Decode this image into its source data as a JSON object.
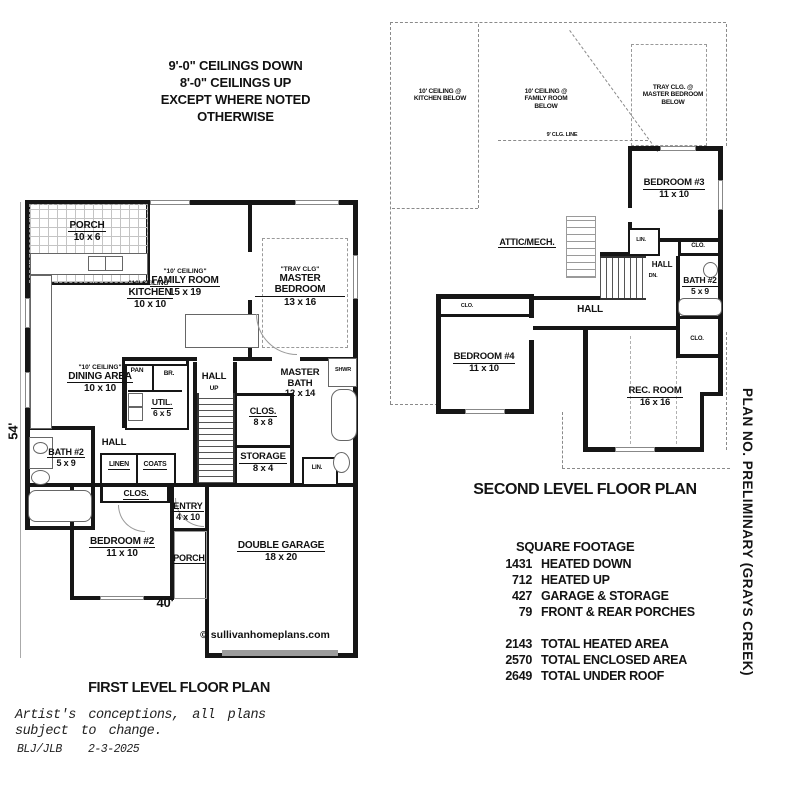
{
  "colors": {
    "ink": "#141414",
    "dash": "#8a8a8a",
    "background": "#ffffff"
  },
  "ceiling_note": {
    "line1": "9'-0\" CEILINGS DOWN",
    "line2": "8'-0\" CEILINGS UP",
    "line3": "EXCEPT WHERE NOTED",
    "line4": "OTHERWISE"
  },
  "first_floor": {
    "title": "FIRST LEVEL FLOOR PLAN",
    "dim_height": "54'",
    "dim_width": "40'",
    "copyright": "© sullivanhomeplans.com",
    "porch_top": {
      "name": "PORCH",
      "size": "10 x 6"
    },
    "kitchen": {
      "ceiling": "\"10' CEILING\"",
      "name": "KITCHEN",
      "size": "10 x 10"
    },
    "family": {
      "ceiling": "\"10' CEILING\"",
      "name": "FAMILY ROOM",
      "size": "15 x 19"
    },
    "master_bedroom": {
      "ceiling": "\"TRAY CLG\"",
      "name": "MASTER BEDROOM",
      "size": "13 x 16"
    },
    "dining": {
      "ceiling": "\"10' CEILING\"",
      "name": "DINING AREA",
      "size": "10 x 10"
    },
    "pantry": "PAN",
    "broom": "BR.",
    "util": {
      "name": "UTIL.",
      "size": "6 x 5"
    },
    "hall_stairs": "HALL",
    "up": "UP",
    "master_bath": {
      "name": "MASTER BATH",
      "size": "12 x 14"
    },
    "shower": "SHWR",
    "master_closet": {
      "name": "CLOS.",
      "size": "8 x 8"
    },
    "storage": {
      "name": "STORAGE",
      "size": "8 x 4"
    },
    "linen_small": "LIN.",
    "hall_lower": "HALL",
    "bath2": {
      "name": "BATH #2",
      "size": "5 x 9"
    },
    "linen": "LINEN",
    "coats": "COATS",
    "closet2": "CLOS.",
    "bedroom2": {
      "name": "BEDROOM #2",
      "size": "11 x 10"
    },
    "entry": {
      "name": "ENTRY",
      "size": "4 x 10"
    },
    "porch_front": "PORCH",
    "garage": {
      "name": "DOUBLE GARAGE",
      "size": "18 x 20"
    }
  },
  "second_floor": {
    "title": "SECOND LEVEL FLOOR PLAN",
    "note_kitchen": "10' CEILING @\nKITCHEN BELOW",
    "note_family": "10' CEILING @\nFAMILY ROOM\nBELOW",
    "note_tray": "TRAY CLG. @\nMASTER BEDROOM\nBELOW",
    "clg_line": "9' CLG. LINE",
    "attic": "ATTIC/MECH.",
    "bedroom3": {
      "name": "BEDROOM #3",
      "size": "11 x 10"
    },
    "closet3": "CLO.",
    "linen": "LIN.",
    "hall_upper": "HALL",
    "down": "DN.",
    "bath2": {
      "name": "BATH #2",
      "size": "5 x 9"
    },
    "closet_bath": "CLO.",
    "bedroom4": {
      "name": "BEDROOM #4",
      "size": "11 x 10"
    },
    "closet4": "CLO.",
    "hall": "HALL",
    "rec_room": {
      "name": "REC. ROOM",
      "size": "16 x 16"
    }
  },
  "square_footage": {
    "title": "SQUARE FOOTAGE",
    "rows": [
      {
        "value": "1431",
        "label": "HEATED DOWN"
      },
      {
        "value": "712",
        "label": "HEATED UP"
      },
      {
        "value": "427",
        "label": "GARAGE & STORAGE"
      },
      {
        "value": "79",
        "label": "FRONT & REAR PORCHES"
      }
    ],
    "totals": [
      {
        "value": "2143",
        "label": "TOTAL HEATED AREA"
      },
      {
        "value": "2570",
        "label": "TOTAL ENCLOSED AREA"
      },
      {
        "value": "2649",
        "label": "TOTAL UNDER ROOF"
      }
    ]
  },
  "plan_no": "PLAN NO.  PRELIMINARY (GRAYS CREEK)",
  "footer": {
    "line1": "Artist's conceptions, all plans",
    "line2": "subject to change.",
    "credit": "BLJ/JLB",
    "date": "2-3-2025"
  }
}
